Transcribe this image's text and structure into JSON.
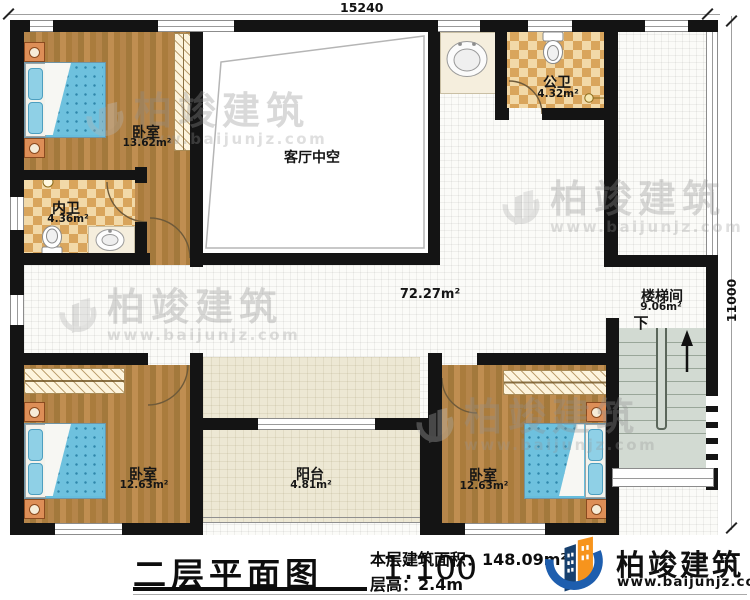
{
  "plan": {
    "dim_top": "15240",
    "dim_right": "11000",
    "rooms": {
      "bedroom_tl": {
        "name": "卧室",
        "area": "13.62m²"
      },
      "inner_bath": {
        "name": "内卫",
        "area": "4.36m²"
      },
      "void": {
        "name": "客厅中空"
      },
      "public_bath": {
        "name": "公卫",
        "area": "4.32m²"
      },
      "hall": {
        "area": "72.27m²"
      },
      "stair": {
        "name": "楼梯间",
        "area": "9.06m²",
        "down_label": "下"
      },
      "bedroom_bl": {
        "name": "卧室",
        "area": "12.63m²"
      },
      "balcony": {
        "name": "阳台",
        "area": "4.81m²"
      },
      "bedroom_br": {
        "name": "卧室",
        "area": "12.63m²"
      }
    }
  },
  "watermark": {
    "brand": "柏竣建筑",
    "site": "www.baijunjz.com"
  },
  "footer": {
    "title": "二层平面图",
    "scale": "1:100",
    "area_label": "本层建筑面积：",
    "area_value": "148.09m²",
    "floor_height_label": "层高：",
    "floor_height_value": "2.4m",
    "brand": "柏竣建筑",
    "site": "www.baijunjz.com"
  },
  "colors": {
    "wall": "#141414",
    "wood": "#b0803f",
    "checker_dark": "#d9a55c",
    "bed_blue": "#6ec1de",
    "stairs": "#d2dad2",
    "balcony": "#ede8d4",
    "logo_blue": "#1e5eae",
    "logo_navy": "#17406e",
    "logo_orange": "#f7941d"
  }
}
